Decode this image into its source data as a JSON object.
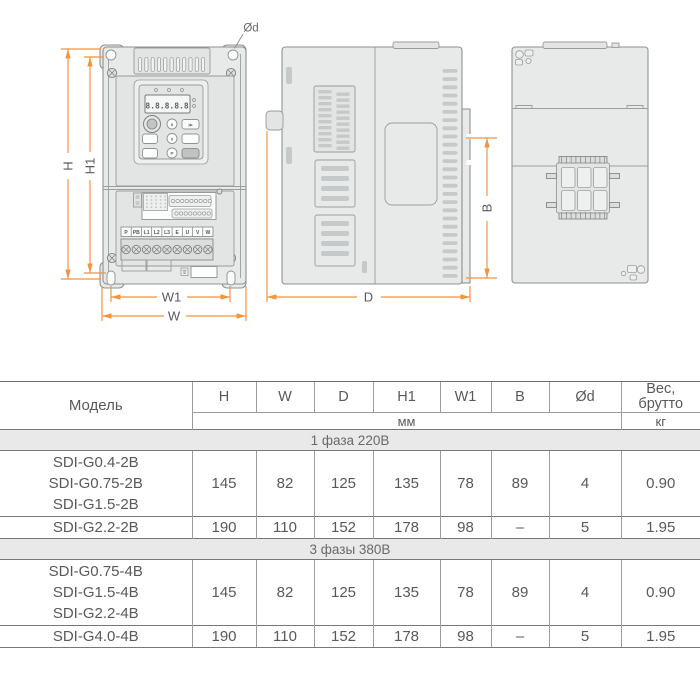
{
  "diagram": {
    "dim_labels": {
      "h": "H",
      "h1": "H1",
      "w": "W",
      "w1": "W1",
      "d": "D",
      "b": "B",
      "od": "Ød"
    },
    "display_text": "8.8.8.8.8",
    "terminals": [
      "P",
      "PB",
      "L1",
      "L2",
      "L3",
      "E",
      "U",
      "V",
      "W"
    ],
    "keypad": {
      "up": "∧",
      "down": "∨",
      "shift": "≫",
      "p": "P"
    },
    "colors": {
      "dimension_line": "#f2953f",
      "drawing_line": "#8f9393",
      "body_fill": "#e8e9e9"
    }
  },
  "table": {
    "model_header": "Модель",
    "columns": [
      "H",
      "W",
      "D",
      "H1",
      "W1",
      "B",
      "Ød"
    ],
    "weight_header_line1": "Вес,",
    "weight_header_line2": "брутто",
    "unit_mm": "мм",
    "unit_kg": "кг",
    "groups": [
      {
        "section": "1 фаза 220В",
        "rows": [
          {
            "models": [
              "SDI-G0.4-2B",
              "SDI-G0.75-2B",
              "SDI-G1.5-2B"
            ],
            "values": [
              "145",
              "82",
              "125",
              "135",
              "78",
              "89",
              "4",
              "0.90"
            ]
          },
          {
            "models": [
              "SDI-G2.2-2B"
            ],
            "values": [
              "190",
              "110",
              "152",
              "178",
              "98",
              "–",
              "5",
              "1.95"
            ]
          }
        ]
      },
      {
        "section": "3 фазы 380В",
        "rows": [
          {
            "models": [
              "SDI-G0.75-4B",
              "SDI-G1.5-4B",
              "SDI-G2.2-4B"
            ],
            "values": [
              "145",
              "82",
              "125",
              "135",
              "78",
              "89",
              "4",
              "0.90"
            ]
          },
          {
            "models": [
              "SDI-G4.0-4B"
            ],
            "values": [
              "190",
              "110",
              "152",
              "178",
              "98",
              "–",
              "5",
              "1.95"
            ]
          }
        ]
      }
    ]
  }
}
